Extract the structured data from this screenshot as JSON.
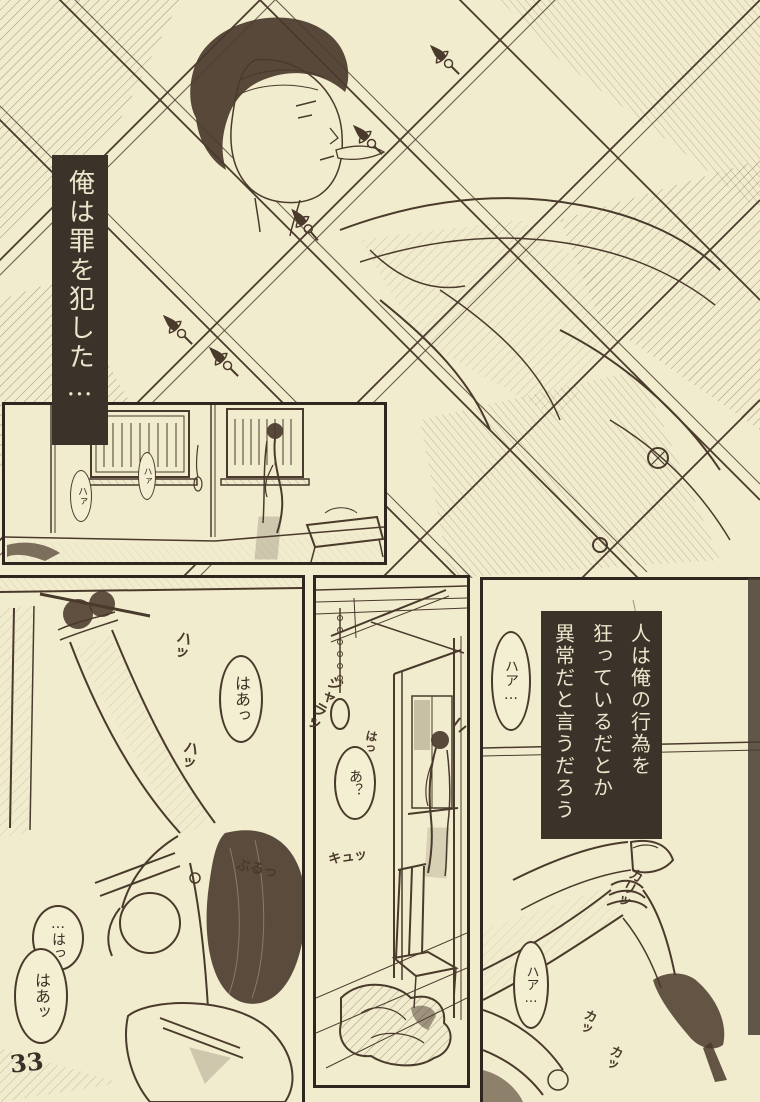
{
  "page": {
    "number": "33"
  },
  "colors": {
    "paper": "#f2ecce",
    "ink": "#4a3a2c",
    "caption_box_bg": "#3b3229",
    "caption_text": "#ece5cb"
  },
  "captions": {
    "monologue1": "俺は罪を犯した…",
    "monologue2": {
      "c1": "人は俺の行為を",
      "c2": "狂っているだとか",
      "c3": "異常だと言うだろう"
    }
  },
  "bubbles": {
    "haa_left": "はあっ",
    "ha_faint_1": "ハァ",
    "ha_faint_2": "ハァ",
    "ha_gasp": "…はっ",
    "haa_gasp": "はあッ",
    "a_surprise": "あ？",
    "haa_top": "ハア…",
    "haa_bottom": "ハア…"
  },
  "sfx": {
    "ha1": "ハッ",
    "ha2": "ハッ",
    "buru": "ぶるっ",
    "jara": "ジャラッ",
    "ha3": "はっ",
    "kyu": "キュッ",
    "kari": "カリッ",
    "ka1": "カッ",
    "ka2": "カッ"
  }
}
